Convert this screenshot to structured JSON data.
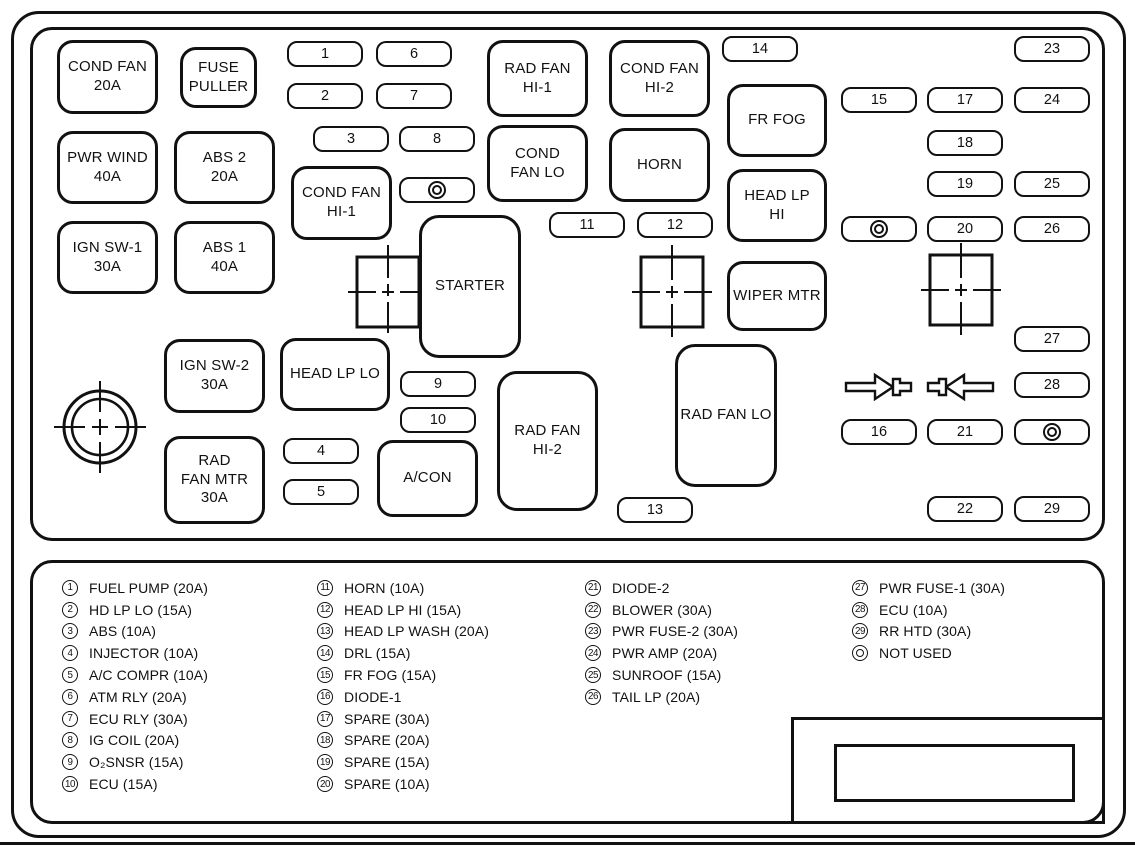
{
  "colors": {
    "ink": "#111111",
    "paper": "#ffffff"
  },
  "diagram": {
    "boxes": [
      {
        "label": "COND FAN\n20A",
        "x": 57,
        "y": 40,
        "w": 101,
        "h": 74
      },
      {
        "label": "FUSE\nPULLER",
        "x": 180,
        "y": 47,
        "w": 77,
        "h": 61
      },
      {
        "label": "RAD FAN\nHI-1",
        "x": 487,
        "y": 40,
        "w": 101,
        "h": 77
      },
      {
        "label": "COND FAN\nHI-2",
        "x": 609,
        "y": 40,
        "w": 101,
        "h": 77
      },
      {
        "label": "FR FOG",
        "x": 727,
        "y": 84,
        "w": 100,
        "h": 73
      },
      {
        "label": "PWR WIND\n40A",
        "x": 57,
        "y": 131,
        "w": 101,
        "h": 73
      },
      {
        "label": "ABS 2\n20A",
        "x": 174,
        "y": 131,
        "w": 101,
        "h": 73
      },
      {
        "label": "COND\nFAN LO",
        "x": 487,
        "y": 125,
        "w": 101,
        "h": 77
      },
      {
        "label": "HORN",
        "x": 609,
        "y": 128,
        "w": 101,
        "h": 74
      },
      {
        "label": "COND FAN\nHI-1",
        "x": 291,
        "y": 166,
        "w": 101,
        "h": 74
      },
      {
        "label": "HEAD LP\nHI",
        "x": 727,
        "y": 169,
        "w": 100,
        "h": 73
      },
      {
        "label": "IGN SW-1\n30A",
        "x": 57,
        "y": 221,
        "w": 101,
        "h": 73
      },
      {
        "label": "ABS 1\n40A",
        "x": 174,
        "y": 221,
        "w": 101,
        "h": 73
      },
      {
        "label": "STARTER",
        "x": 419,
        "y": 215,
        "w": 102,
        "h": 143
      },
      {
        "label": "WIPER MTR",
        "x": 727,
        "y": 261,
        "w": 100,
        "h": 70
      },
      {
        "label": "IGN SW-2\n30A",
        "x": 164,
        "y": 339,
        "w": 101,
        "h": 74
      },
      {
        "label": "HEAD LP LO",
        "x": 280,
        "y": 338,
        "w": 110,
        "h": 73
      },
      {
        "label": "RAD FAN LO",
        "x": 675,
        "y": 344,
        "w": 102,
        "h": 143
      },
      {
        "label": "RAD FAN\nHI-2",
        "x": 497,
        "y": 371,
        "w": 101,
        "h": 140
      },
      {
        "label": "RAD\nFAN MTR\n30A",
        "x": 164,
        "y": 436,
        "w": 101,
        "h": 88
      },
      {
        "label": "A/CON",
        "x": 377,
        "y": 440,
        "w": 101,
        "h": 77
      }
    ],
    "slots": [
      {
        "n": "1",
        "x": 287,
        "y": 41
      },
      {
        "n": "2",
        "x": 287,
        "y": 83
      },
      {
        "n": "3",
        "x": 313,
        "y": 126
      },
      {
        "n": "4",
        "x": 283,
        "y": 438
      },
      {
        "n": "5",
        "x": 283,
        "y": 479
      },
      {
        "n": "6",
        "x": 376,
        "y": 41
      },
      {
        "n": "7",
        "x": 376,
        "y": 83
      },
      {
        "n": "8",
        "x": 399,
        "y": 126
      },
      {
        "n": "9",
        "x": 400,
        "y": 371
      },
      {
        "n": "10",
        "x": 400,
        "y": 407
      },
      {
        "n": "11",
        "x": 549,
        "y": 212
      },
      {
        "n": "12",
        "x": 637,
        "y": 212
      },
      {
        "n": "13",
        "x": 617,
        "y": 497
      },
      {
        "n": "14",
        "x": 722,
        "y": 36
      },
      {
        "n": "15",
        "x": 841,
        "y": 87
      },
      {
        "n": "16",
        "x": 841,
        "y": 419
      },
      {
        "n": "17",
        "x": 927,
        "y": 87
      },
      {
        "n": "18",
        "x": 927,
        "y": 130
      },
      {
        "n": "19",
        "x": 927,
        "y": 171
      },
      {
        "n": "20",
        "x": 927,
        "y": 216
      },
      {
        "n": "21",
        "x": 927,
        "y": 419
      },
      {
        "n": "22",
        "x": 927,
        "y": 496
      },
      {
        "n": "23",
        "x": 1014,
        "y": 36
      },
      {
        "n": "24",
        "x": 1014,
        "y": 87
      },
      {
        "n": "25",
        "x": 1014,
        "y": 171
      },
      {
        "n": "26",
        "x": 1014,
        "y": 216
      },
      {
        "n": "27",
        "x": 1014,
        "y": 326
      },
      {
        "n": "28",
        "x": 1014,
        "y": 372
      },
      {
        "n": "29",
        "x": 1014,
        "y": 496
      }
    ],
    "not_used_slots": [
      {
        "x": 399,
        "y": 177
      },
      {
        "x": 841,
        "y": 216
      },
      {
        "x": 1014,
        "y": 419
      }
    ]
  },
  "legend": {
    "columns": [
      {
        "x": 62,
        "items": [
          {
            "n": "1",
            "label": "FUEL PUMP (20A)"
          },
          {
            "n": "2",
            "label": "HD LP LO (15A)"
          },
          {
            "n": "3",
            "label": "ABS (10A)"
          },
          {
            "n": "4",
            "label": "INJECTOR (10A)"
          },
          {
            "n": "5",
            "label": "A/C COMPR (10A)"
          },
          {
            "n": "6",
            "label": "ATM RLY (20A)"
          },
          {
            "n": "7",
            "label": "ECU RLY (30A)"
          },
          {
            "n": "8",
            "label": "IG COIL (20A)"
          },
          {
            "n": "9",
            "label": "O₂SNSR (15A)"
          },
          {
            "n": "10",
            "label": "ECU (15A)"
          }
        ]
      },
      {
        "x": 317,
        "items": [
          {
            "n": "11",
            "label": "HORN (10A)"
          },
          {
            "n": "12",
            "label": "HEAD LP HI (15A)"
          },
          {
            "n": "13",
            "label": "HEAD LP WASH (20A)"
          },
          {
            "n": "14",
            "label": "DRL (15A)"
          },
          {
            "n": "15",
            "label": "FR FOG (15A)"
          },
          {
            "n": "16",
            "label": "DIODE-1"
          },
          {
            "n": "17",
            "label": "SPARE (30A)"
          },
          {
            "n": "18",
            "label": "SPARE (20A)"
          },
          {
            "n": "19",
            "label": "SPARE (15A)"
          },
          {
            "n": "20",
            "label": "SPARE (10A)"
          }
        ]
      },
      {
        "x": 585,
        "items": [
          {
            "n": "21",
            "label": "DIODE-2"
          },
          {
            "n": "22",
            "label": "BLOWER (30A)"
          },
          {
            "n": "23",
            "label": "PWR FUSE-2 (30A)"
          },
          {
            "n": "24",
            "label": "PWR AMP (20A)"
          },
          {
            "n": "25",
            "label": "SUNROOF (15A)"
          },
          {
            "n": "26",
            "label": "TAIL LP (20A)"
          }
        ]
      },
      {
        "x": 852,
        "items": [
          {
            "n": "27",
            "label": "PWR FUSE-1 (30A)"
          },
          {
            "n": "28",
            "label": "ECU (10A)"
          },
          {
            "n": "29",
            "label": "RR HTD (30A)"
          },
          {
            "n": "",
            "double": true,
            "label": "NOT USED"
          }
        ]
      }
    ]
  }
}
